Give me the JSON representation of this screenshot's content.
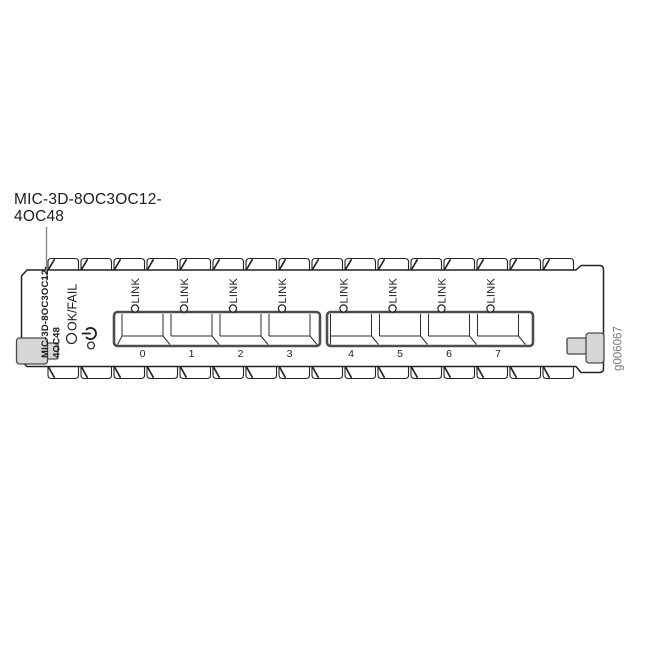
{
  "callout": {
    "line1": "MIC-3D-8OC3OC12-",
    "line2": "4OC48"
  },
  "figure_id": "g006067",
  "faceplate": {
    "model_line1": "MIC-3D-8OC3OC12-",
    "model_line2": "4OC48",
    "okfail_label": "OK/FAIL",
    "power_icon": "power-standby-icon",
    "ports": [
      {
        "number": "0",
        "link_label": "LINK"
      },
      {
        "number": "1",
        "link_label": "LINK"
      },
      {
        "number": "2",
        "link_label": "LINK"
      },
      {
        "number": "3",
        "link_label": "LINK"
      },
      {
        "number": "4",
        "link_label": "LINK"
      },
      {
        "number": "5",
        "link_label": "LINK"
      },
      {
        "number": "6",
        "link_label": "LINK"
      },
      {
        "number": "7",
        "link_label": "LINK"
      }
    ]
  },
  "colors": {
    "line_art": "#222222",
    "port_group_border": "#4d4d4d",
    "screw_fill": "#d6d6d6",
    "leader_line": "#8a8a8a",
    "figure_id_text": "#7a7a7a",
    "background": "#ffffff"
  }
}
